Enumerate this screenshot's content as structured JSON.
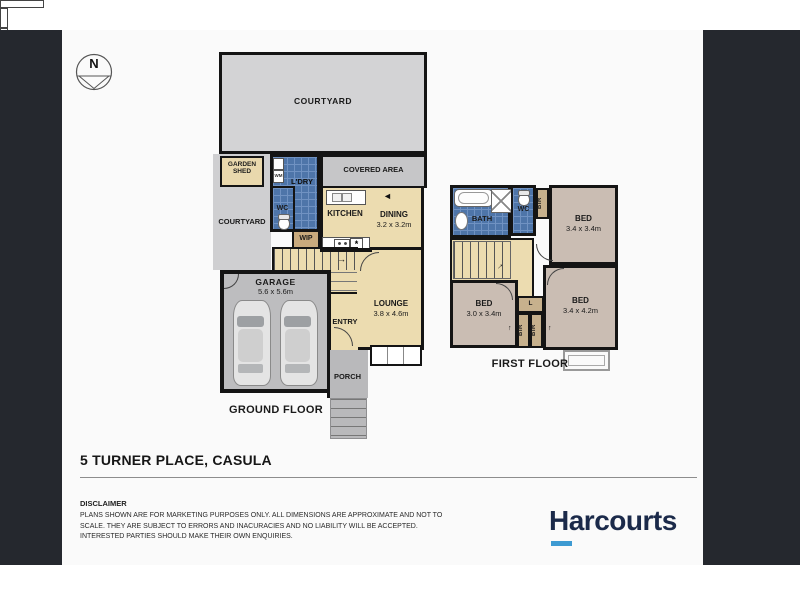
{
  "compass": {
    "label": "N"
  },
  "icons": {
    "stair_arrow_right": "→",
    "stair_arrow_up": "↑",
    "slider_arrow_left": "◄",
    "dishwasher_symbol": "*"
  },
  "ground_floor": {
    "title": "GROUND FLOOR",
    "rooms": {
      "courtyard_top": "COURTYARD",
      "garden_shed": "GARDEN SHED",
      "courtyard_side": "COURTYARD",
      "laundry": "L'DRY",
      "wc": "WC",
      "covered_area": "COVERED AREA",
      "kitchen": "KITCHEN",
      "dining": "DINING",
      "dining_dim": "3.2 x 3.2m",
      "wip": "WIP",
      "garage": "GARAGE",
      "garage_dim": "5.6 x 5.6m",
      "lounge": "LOUNGE",
      "lounge_dim": "3.8 x 4.6m",
      "entry": "ENTRY",
      "porch": "PORCH"
    },
    "appliances": {
      "washing_machine": "WM"
    }
  },
  "first_floor": {
    "title": "FIRST FLOOR",
    "rooms": {
      "bath": "BATH",
      "wc": "WC",
      "bir1": "BIR",
      "bed1": "BED",
      "bed1_dim": "3.4 x 3.4m",
      "bed2": "BED",
      "bed2_dim": "3.0 x 3.4m",
      "bed3": "BED",
      "bed3_dim": "3.4 x 4.2m",
      "linen": "L",
      "bir2": "BIR",
      "bir3": "BIR"
    }
  },
  "footer": {
    "address": "5 TURNER PLACE, CASULA",
    "disclaimer_heading": "DISCLAIMER",
    "disclaimer_body": "PLANS SHOWN ARE FOR MARKETING PURPOSES ONLY. ALL DIMENSIONS ARE APPROXIMATE AND NOT TO SCALE. THEY ARE SUBJECT TO ERRORS AND INACURACIES AND NO LIABILITY WILL BE ACCEPTED. INTERESTED PARTIES SHOULD MAKE THEIR OWN ENQUIRIES.",
    "brand": "Harcourts"
  },
  "colors": {
    "panel_dark": "#25282e",
    "wall": "#141414",
    "tile_blue": "#4e75a9",
    "room_beige": "#ecdcb0",
    "room_mauve": "#cabdb3",
    "brand_navy": "#1b2a4a",
    "brand_blue": "#3d9ad2"
  }
}
